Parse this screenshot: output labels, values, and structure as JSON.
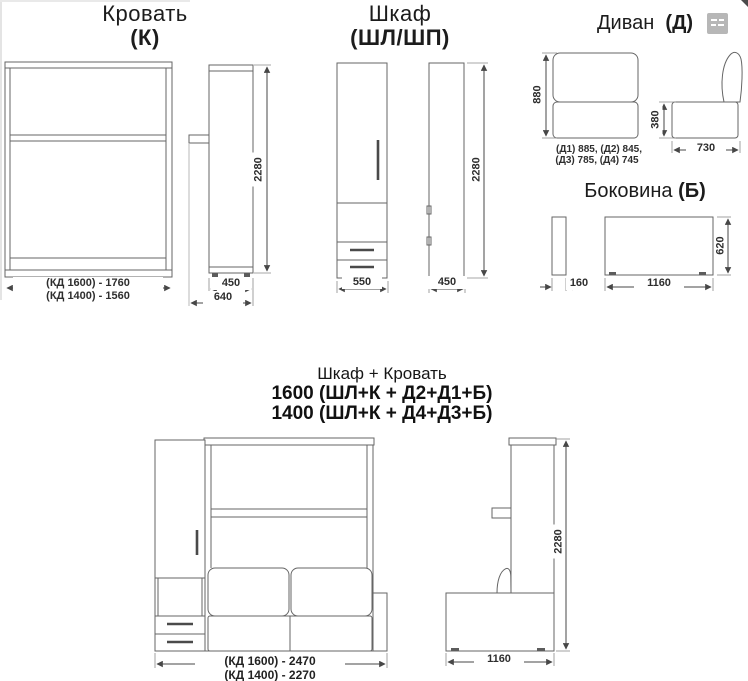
{
  "bed": {
    "title": "Кровать",
    "code": "(К)",
    "dims": {
      "width_1600": "(КД 1600) - 1760",
      "width_1400": "(КД 1400) - 1560",
      "height": "2280",
      "depth": "450",
      "depth_total": "640"
    }
  },
  "wardrobe": {
    "title": "Шкаф",
    "code": "(ШЛ/ШП)",
    "dims": {
      "width": "550",
      "depth": "450",
      "height": "2280"
    }
  },
  "sofa": {
    "title": "Диван",
    "code": "(Д)",
    "dims": {
      "height": "880",
      "widths_line1": "(Д1) 885, (Д2) 845,",
      "widths_line2": "(Д3) 785, (Д4) 745",
      "seat_height": "380",
      "depth": "730"
    }
  },
  "side_panel": {
    "title": "Боковина",
    "code": "(Б)",
    "dims": {
      "thickness": "160",
      "length": "1160",
      "height": "620"
    }
  },
  "combo": {
    "title": "Шкаф + Кровать",
    "config_1600": "1600 (ШЛ+К + Д2+Д1+Б)",
    "config_1400": "1400 (ШЛ+К + Д4+Д3+Б)",
    "dims": {
      "width_1600": "(КД 1600) - 2470",
      "width_1400": "(КД 1400) - 2270",
      "depth": "1160",
      "height": "2280"
    }
  }
}
